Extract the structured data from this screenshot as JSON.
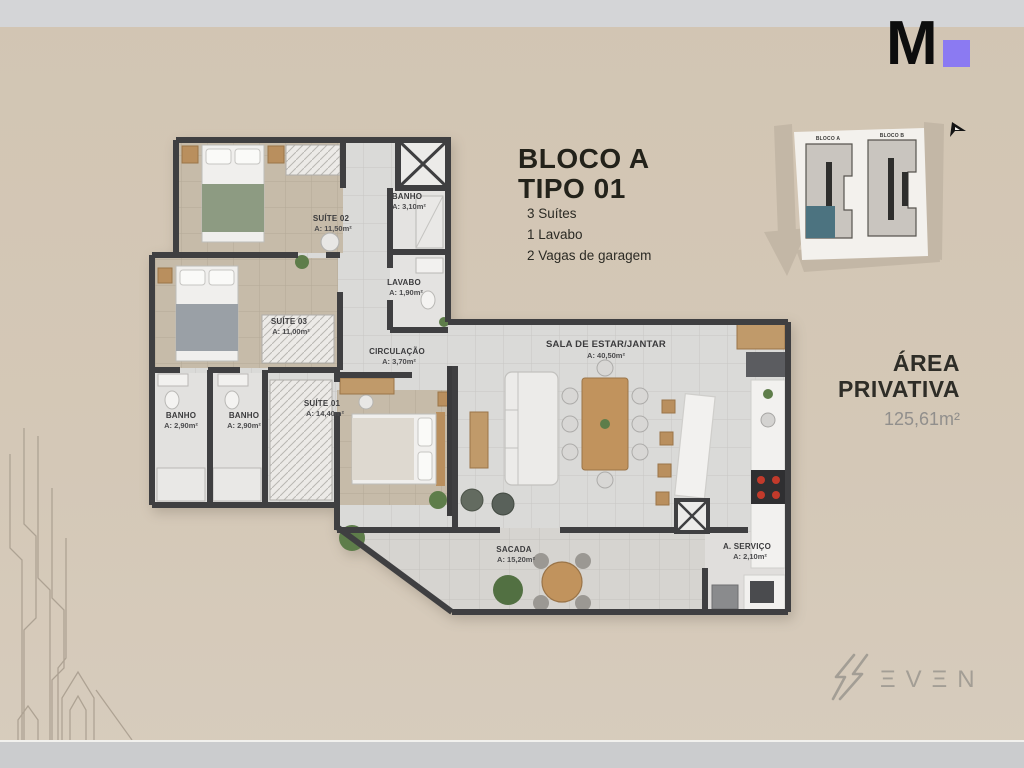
{
  "logo": {
    "letter": "M",
    "square_color": "#8b7af2"
  },
  "title": {
    "line1": "BLOCO A",
    "line2": "TIPO 01",
    "features": [
      "3 Suítes",
      "1 Lavabo",
      "2 Vagas de garagem"
    ]
  },
  "site_plan": {
    "bloco_a": "BLOCO A",
    "bloco_b": "BLOCO B",
    "highlight_color": "#4c7380"
  },
  "area": {
    "line1": "ÁREA",
    "line2": "PRIVATIVA",
    "value": "125,61m²"
  },
  "brand": {
    "name": "SEVEN",
    "glyphs": "ΞVΞN"
  },
  "plan": {
    "rooms": [
      {
        "name": "SUÍTE 02",
        "area": "A: 11,50m²"
      },
      {
        "name": "BANHO",
        "area": "A: 3,10m²"
      },
      {
        "name": "LAVABO",
        "area": "A: 1,90m²"
      },
      {
        "name": "SUÍTE 03",
        "area": "A: 11,00m²"
      },
      {
        "name": "CIRCULAÇÃO",
        "area": "A: 3,70m²"
      },
      {
        "name": "SUÍTE 01",
        "area": "A: 14,40m²"
      },
      {
        "name": "BANHO",
        "area": "A: 2,90m²"
      },
      {
        "name": "BANHO",
        "area": "A: 2,90m²"
      },
      {
        "name": "SALA DE ESTAR/JANTAR",
        "area": "A: 40,50m²"
      },
      {
        "name": "SACADA",
        "area": "A: 15,20m²"
      },
      {
        "name": "A. SERVIÇO",
        "area": "A: 2,10m²"
      }
    ]
  }
}
